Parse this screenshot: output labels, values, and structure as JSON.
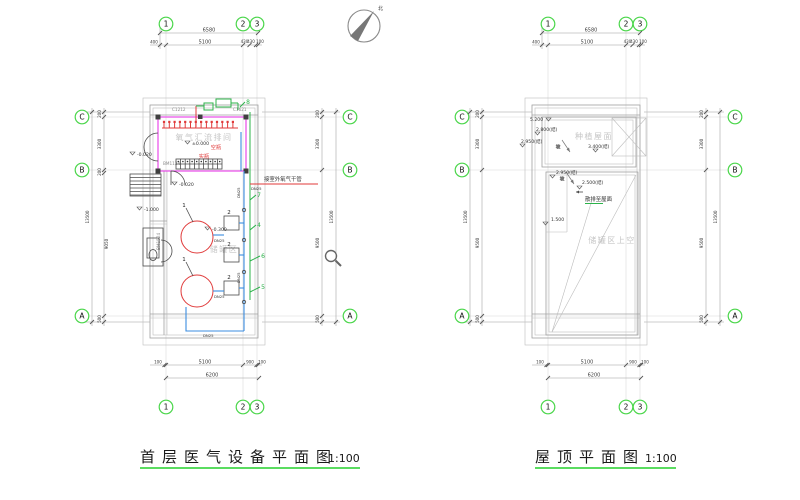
{
  "titles": {
    "left_title": "首层医气设备平面图",
    "left_scale": "1:100",
    "right_title": "屋顶平面图",
    "right_scale": "1:100"
  },
  "compass": {
    "north_label": "北"
  },
  "grid": {
    "cols": [
      "1",
      "2",
      "3"
    ],
    "rows": [
      "C",
      "B",
      "A"
    ]
  },
  "colors": {
    "grid_bubble_green": "#4ad64a",
    "wall_magenta": "#e83ae8",
    "pipe_blue": "#3b8de0",
    "pipe_green": "#2cb34a",
    "equipment_red": "#e03a3a",
    "title_underline_green": "#24d02c"
  },
  "left_plan": {
    "dims": {
      "top_total": "6580",
      "top_segments": [
        "400",
        "5100",
        "430",
        "430",
        "100"
      ],
      "bottom_total": "6200",
      "bottom_segments": [
        "100",
        "5100",
        "900",
        "100"
      ],
      "left_total": "13500",
      "left_segments": [
        "200",
        "3300",
        "200",
        "9050",
        "500"
      ],
      "right_total": "13500",
      "right_segments": [
        "200",
        "3300",
        "9500",
        "500"
      ]
    },
    "rooms": {
      "manifold_room": "氧气汇流排间",
      "tank_area": "储罐区"
    },
    "openings": {
      "window_1": "C1212",
      "window_2": "C1621",
      "door_1": "BM1124",
      "door_2": "BM1524"
    },
    "elevations": {
      "zero": "±0.000",
      "neg_020_a": "-0.020",
      "neg_020_b": "-0.020",
      "neg_100": "-1.000",
      "neg_030": "-0.300"
    },
    "equipment": {
      "empty_bottles": "空瓶",
      "full_bottles": "实瓶"
    },
    "notes": {
      "outdoor_pipe": "接室外氧气干管"
    },
    "pipes": {
      "dn25": "DN25"
    },
    "callouts": {
      "c1": "1",
      "c2": "2",
      "c4": "4",
      "c5": "5",
      "c6": "6",
      "c7": "7",
      "c8": "8"
    }
  },
  "right_plan": {
    "dims": {
      "top_total": "6580",
      "top_segments": [
        "400",
        "5100",
        "430",
        "430",
        "100"
      ],
      "bottom_total": "6200",
      "bottom_segments": [
        "100",
        "5100",
        "900",
        "100"
      ],
      "left_total": "13500",
      "left_segments": [
        "200",
        "3300",
        "9500",
        "500"
      ],
      "right_total": "13500",
      "right_segments": [
        "200",
        "3300",
        "9500",
        "500"
      ]
    },
    "rooms": {
      "planted_roof": "种植屋面",
      "above_tank_area": "储罐区上空"
    },
    "notes": {
      "drain_to_roof": "散排至屋面",
      "slope": "坡"
    },
    "elevations": {
      "e_5200": "5.200",
      "e_2800": "2.800(结)",
      "e_2950_a": "2.950(结)",
      "e_2950_b": "2.950(结)",
      "e_3400": "3.400(结)",
      "e_2500": "2.500(结)",
      "e_1500": "1.500"
    }
  }
}
